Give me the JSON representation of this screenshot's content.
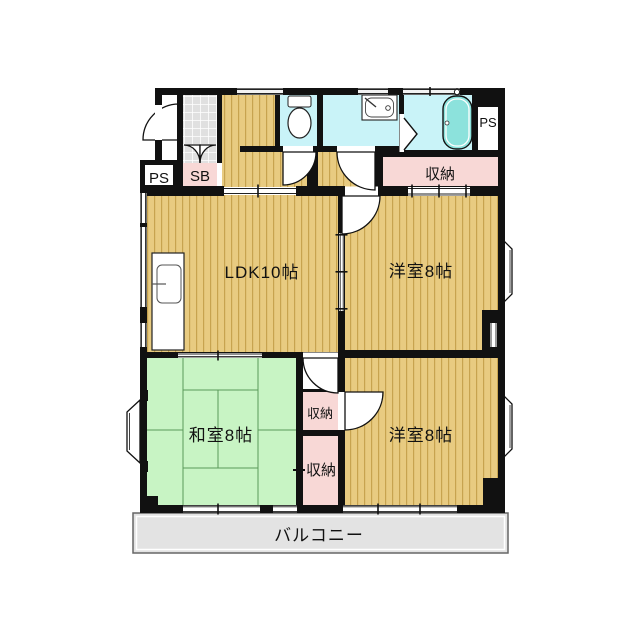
{
  "labels": {
    "ps_left": "PS",
    "sb": "SB",
    "closet_hall": "収納",
    "ps_right": "PS",
    "ldk": "LDK10帖",
    "western_top": "洋室8帖",
    "western_bottom": "洋室8帖",
    "japanese": "和室8帖",
    "closet_mid": "収納",
    "closet_low": "収納",
    "balcony": "バルコニー"
  },
  "colors": {
    "wall": "#111111",
    "wood_floor": "#e8cb81",
    "wood_stripe": "#c7a34f",
    "tatami": "#c8f4c4",
    "water_rooms": "#c9f3f8",
    "closet": "#f8d8d6",
    "bathtub": "#8ce2dc",
    "entrance_tile": "#e0e0e0",
    "balcony_floor": "#e3e3e3"
  }
}
